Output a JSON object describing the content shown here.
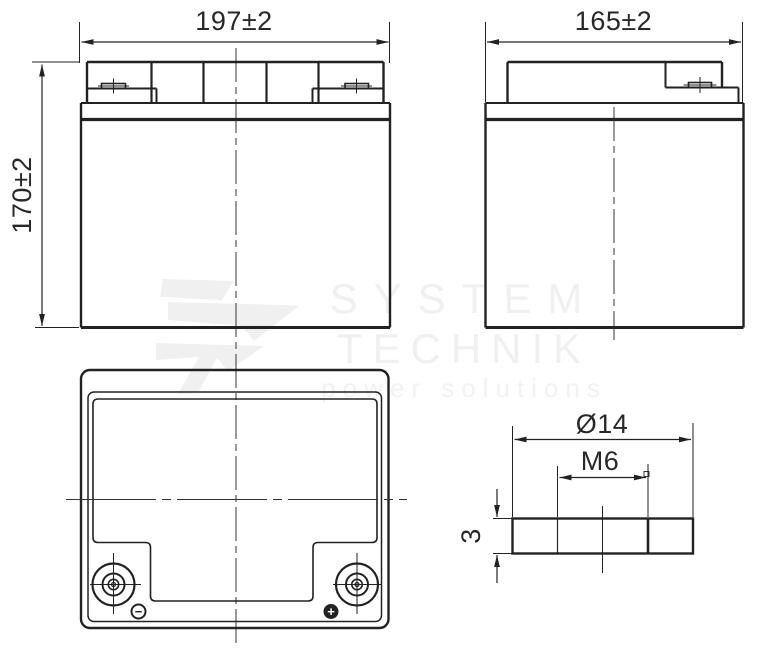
{
  "drawing": {
    "front_view": {
      "width_dim": "197±2",
      "height_dim": "170±2"
    },
    "side_view": {
      "width_dim": "165±2"
    },
    "top_view": {
      "negative_symbol": "−",
      "positive_symbol": "+"
    },
    "terminal_detail": {
      "diameter_dim": "Ø14",
      "thread_dim": "M6",
      "height_dim": "3"
    }
  },
  "watermark": {
    "brand_line1": "SYSTEM",
    "brand_line2": "TECHNIK",
    "tagline": "power solutions"
  },
  "colors": {
    "line": "#222222",
    "centerline": "#333333",
    "watermark": "#f0f0f0",
    "background": "#ffffff"
  }
}
